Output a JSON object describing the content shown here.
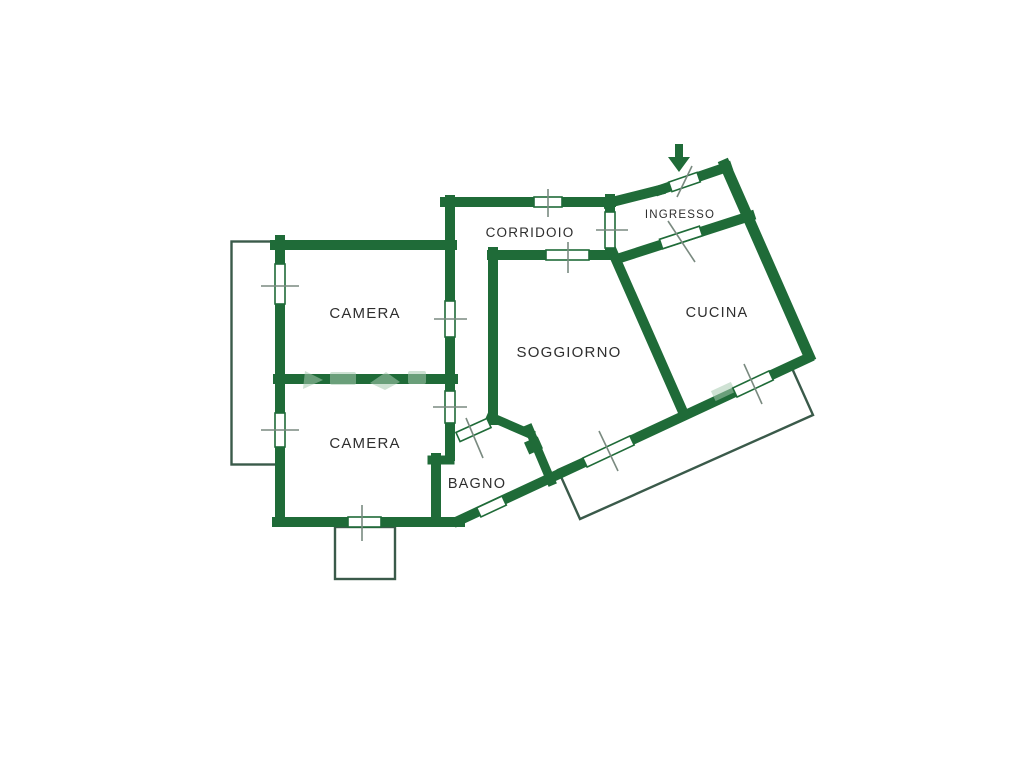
{
  "floorplan": {
    "rooms": [
      {
        "id": "camera-1",
        "label": "CAMERA"
      },
      {
        "id": "camera-2",
        "label": "CAMERA"
      },
      {
        "id": "soggiorno",
        "label": "SOGGIORNO"
      },
      {
        "id": "corridoio",
        "label": "CORRIDOIO"
      },
      {
        "id": "ingresso",
        "label": "INGRESSO"
      },
      {
        "id": "cucina",
        "label": "CUCINA"
      },
      {
        "id": "bagno",
        "label": "BAGNO"
      }
    ],
    "colors": {
      "wall": "#1f6b38",
      "balcony_outline": "#3a5a4a",
      "tick": "#7a8a80",
      "label": "#2e2e2e",
      "background": "#ffffff",
      "watermark": "#a8cbb1"
    },
    "icons": [
      {
        "name": "entrance-arrow-icon",
        "meaning": "entrance direction",
        "glyph": "▼"
      }
    ]
  }
}
